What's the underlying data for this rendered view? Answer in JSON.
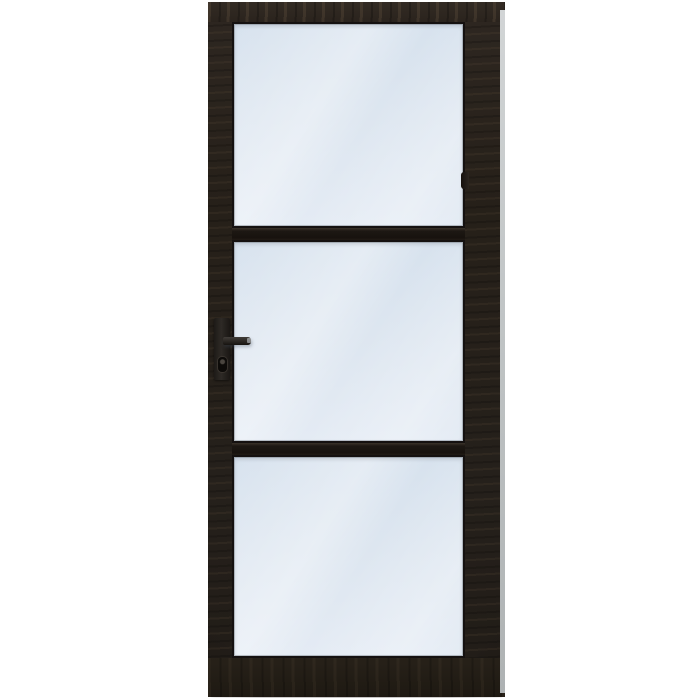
{
  "scene": {
    "description": "Product photo of a black wooden industrial-style interior door with three light-blue glass panes separated by two slim horizontal mullions, a black lever handle with keyhole on the left stile, shown on a plain white background",
    "background_color": "#ffffff",
    "object": "interior door",
    "style": "industrial steel-look, 3-pane",
    "pane_count": 3
  },
  "door": {
    "frame_color": "#262019",
    "frame_grain_highlight": "#6e5a42",
    "glazing_bead_color": "#151110",
    "mullion_color": "#1d1813",
    "glass_color_top": "#d7e2ee",
    "glass_color_bottom": "#e4ebf4",
    "edge_strip_color": "#c2c6c7",
    "panes": [
      {
        "position": "top"
      },
      {
        "position": "middle"
      },
      {
        "position": "bottom"
      }
    ],
    "hardware": {
      "handle_type": "lever handle on backplate",
      "handle_side": "left",
      "handle_color": "#2b2723",
      "lever_tip_highlight": "#d2d7dc",
      "keyhole_color": "#0d0b09",
      "latch_keep_color": "#2a2520"
    }
  }
}
